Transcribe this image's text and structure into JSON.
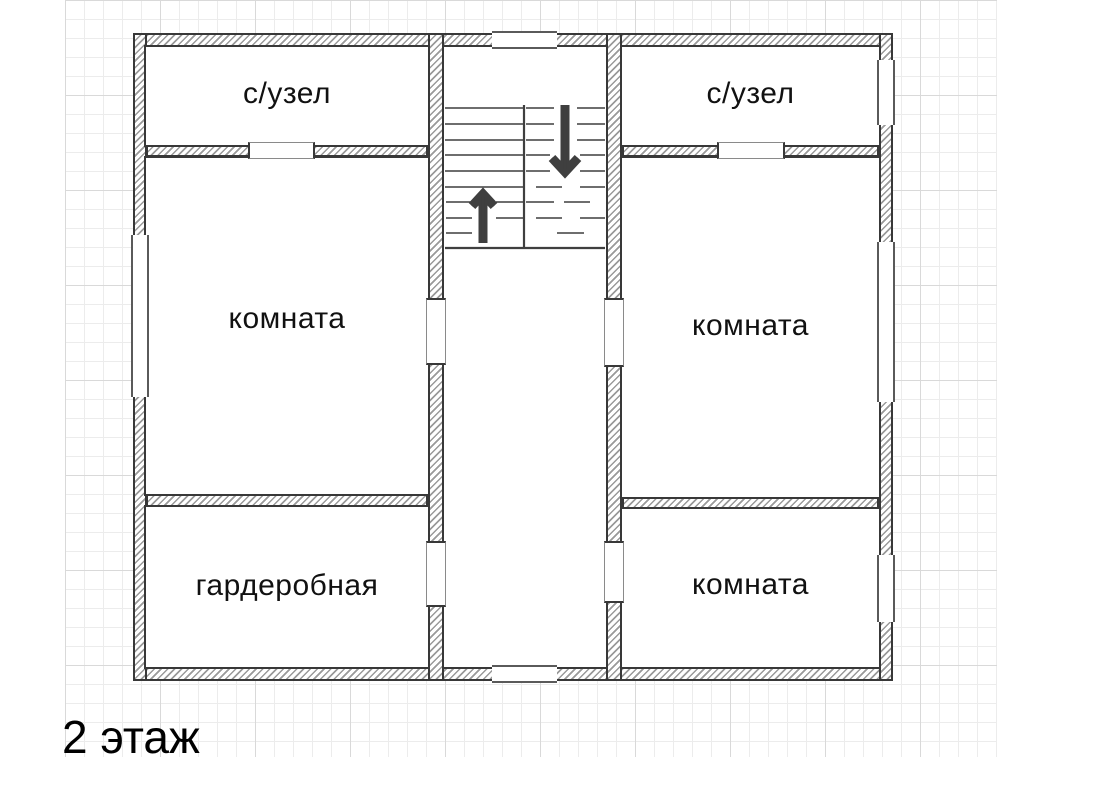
{
  "floor_label": "2 этаж",
  "rooms": {
    "bathroom_left": {
      "label": "с/узел"
    },
    "bathroom_right": {
      "label": "с/узел"
    },
    "room_left": {
      "label": "комната"
    },
    "room_right": {
      "label": "комната"
    },
    "wardrobe": {
      "label": "гардеробная"
    },
    "room_bottom_right": {
      "label": "комната"
    }
  },
  "stairs": {
    "up_arrow_icon": "stairs-up-arrow",
    "down_arrow_icon": "stairs-down-arrow"
  },
  "colors": {
    "wall_border": "#383838",
    "wall_hatch": "#9a9a9a",
    "line": "#3f3f3f",
    "grid_minor": "#ececec",
    "grid_major": "#d9d9d9",
    "frame": "#5a5a5a",
    "text": "#111111"
  }
}
